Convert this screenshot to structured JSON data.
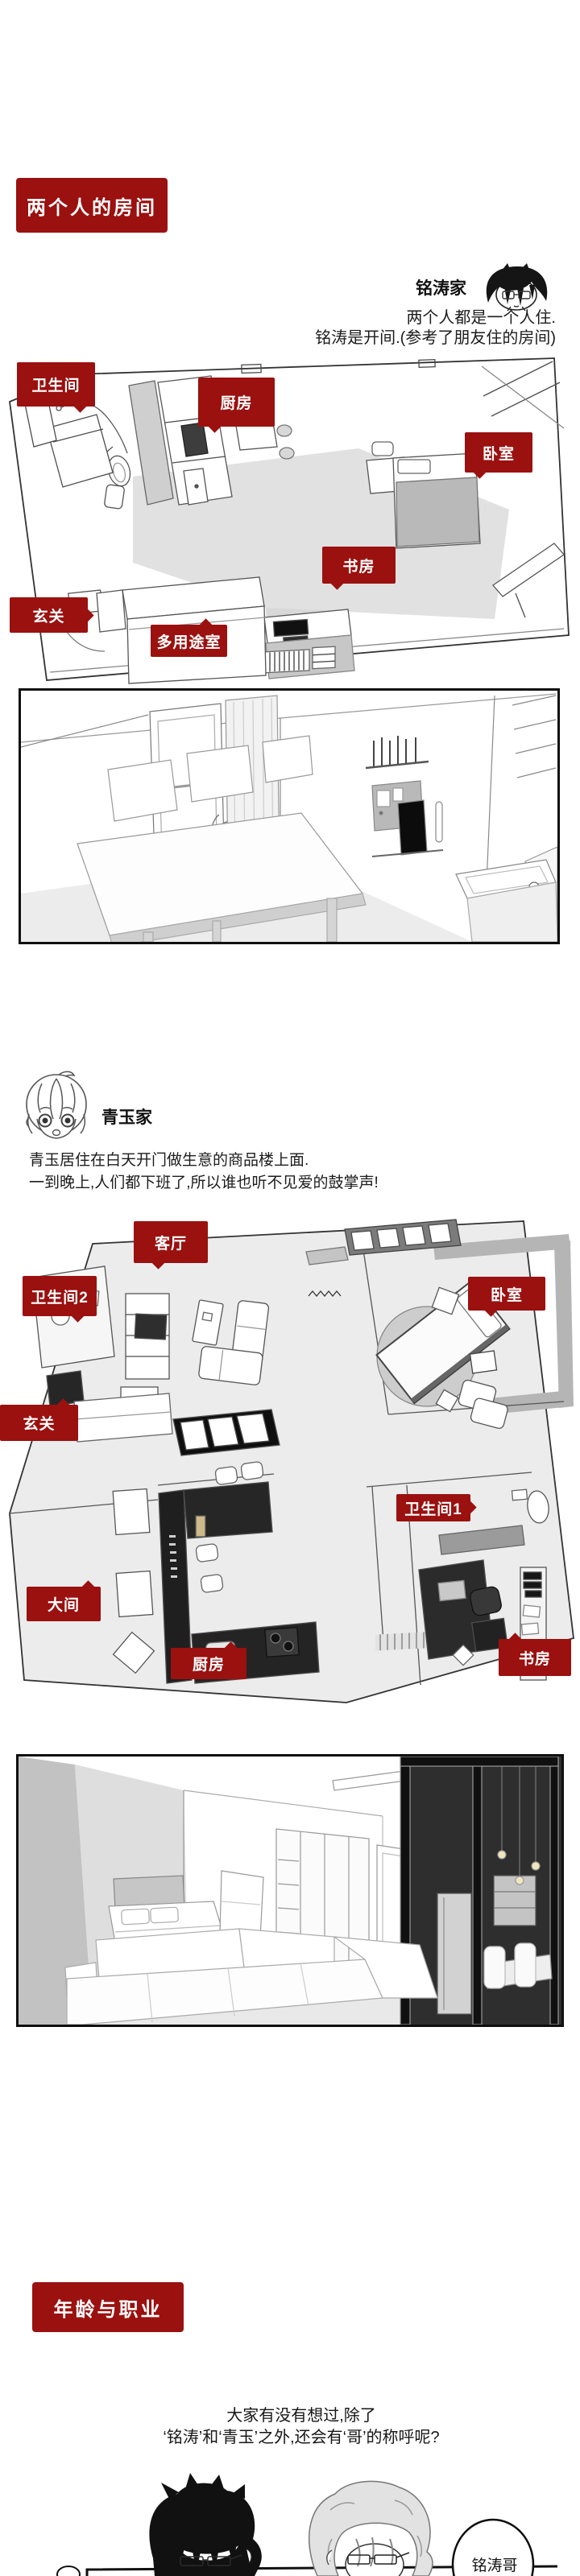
{
  "accent": "#9a1110",
  "intro": {
    "tag": "两个人的房间"
  },
  "mingtao": {
    "name": "铭涛家",
    "desc1": "两个人都是一个人住.",
    "desc2": "铭涛是开间.(参考了朋友住的房间)",
    "labels": {
      "bathroom": "卫生间",
      "kitchen": "厨房",
      "bedroom": "卧室",
      "study": "书房",
      "entry": "玄关",
      "multi": "多用途室"
    }
  },
  "qingyu": {
    "name": "青玉家",
    "desc1": "青玉居住在白天开门做生意的商品楼上面.",
    "desc2": "一到晚上,人们都下班了,所以谁也听不见爱的鼓掌声!",
    "labels": {
      "living": "客厅",
      "bathroom2": "卫生间2",
      "bedroom": "卧室",
      "entry": "玄关",
      "bathroom1": "卫生间1",
      "bigroom": "大间",
      "kitchen": "厨房",
      "study": "书房"
    }
  },
  "age": {
    "tag": "年龄与职业",
    "line1": "大家有没有想过,除了",
    "line2": "‘铭涛’和‘青玉’之外,还会有‘哥’的称呼呢?",
    "bubble": "铭涛哥"
  }
}
